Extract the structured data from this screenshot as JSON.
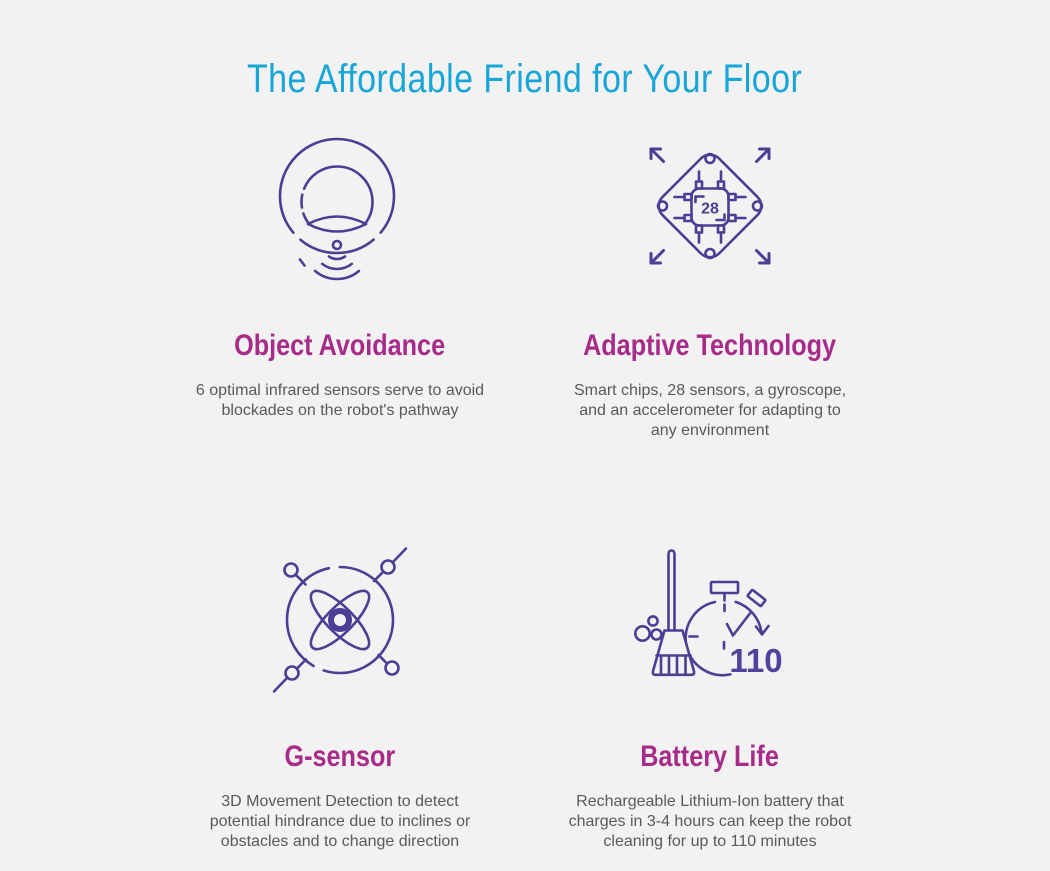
{
  "page": {
    "title": "The Affordable Friend for Your Floor"
  },
  "theme": {
    "background_color": "#f2f2f2",
    "title_color": "#17a6d7",
    "heading_color": "#a72b89",
    "body_text_color": "#59595b",
    "icon_stroke_color": "#4c3e94",
    "icon_number_color": "#51429b"
  },
  "features": [
    {
      "id": "object-avoidance",
      "icon": "robot-vacuum-sensor-icon",
      "title": "Object Avoidance",
      "description": "6 optimal infrared sensors serve to avoid\nblockades on the robot's pathway"
    },
    {
      "id": "adaptive-technology",
      "icon": "smart-chip-icon",
      "icon_label": "28",
      "title": "Adaptive Technology",
      "description": "Smart chips, 28 sensors, a gyroscope,\nand an accelerometer for adapting to\nany environment"
    },
    {
      "id": "g-sensor",
      "icon": "gyroscope-atom-icon",
      "title": "G-sensor",
      "description": "3D Movement Detection to detect\npotential hindrance due to inclines or\nobstacles and to change direction"
    },
    {
      "id": "battery-life",
      "icon": "stopwatch-broom-icon",
      "icon_label": "110",
      "title": "Battery Life",
      "description": "Rechargeable Lithium-Ion battery that\ncharges in 3-4 hours can keep the robot\ncleaning for up to 110 minutes"
    }
  ]
}
